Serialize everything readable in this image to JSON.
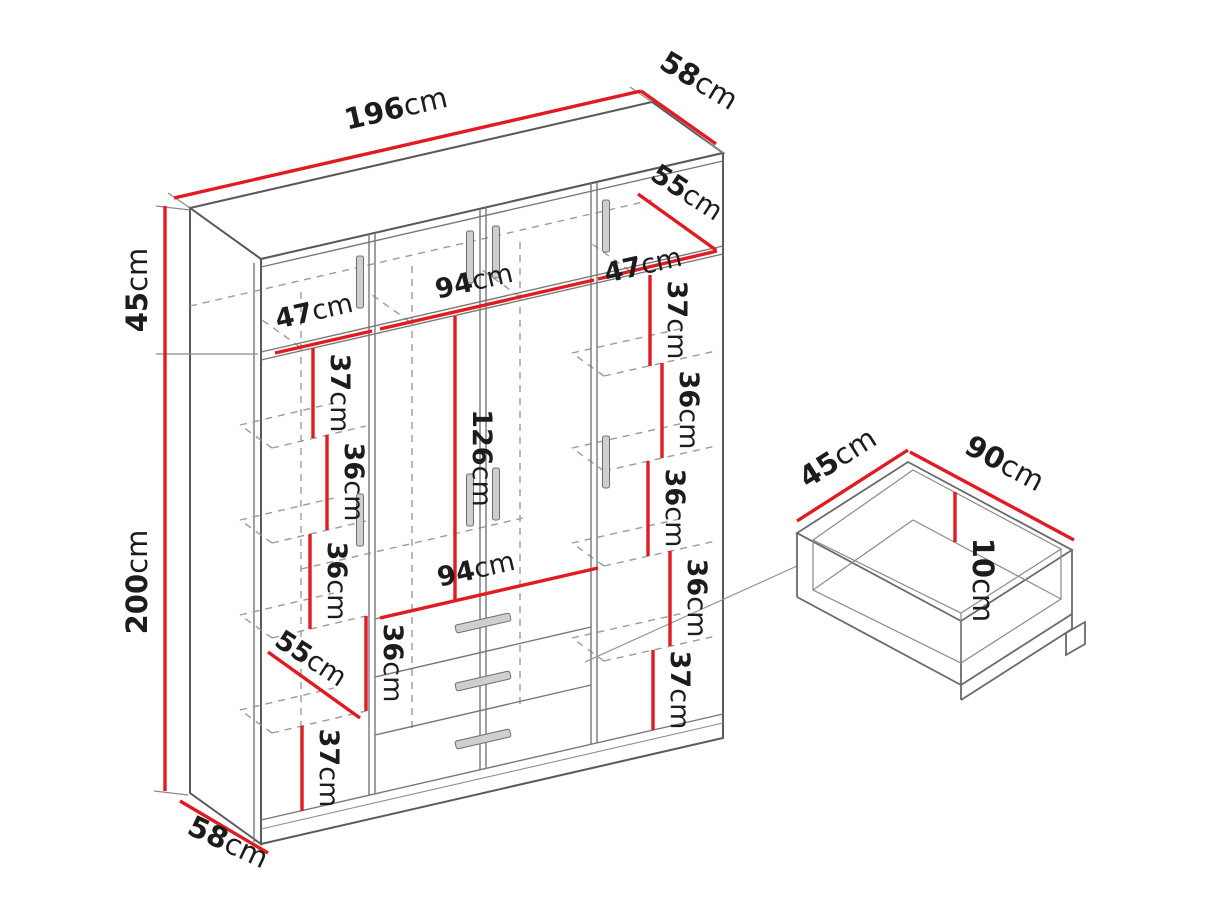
{
  "diagram": {
    "type": "furniture-dimension-diagram",
    "subject": "four-door wardrobe with drawers and drawer detail inset",
    "unit": "cm",
    "colors": {
      "dimension_red": "#e01b22",
      "line_gray": "#5a5a5a",
      "dash_gray": "#9b9b9b",
      "text": "#1c1c1c",
      "handle_gray": "#cfcfcf"
    },
    "wardrobe": {
      "overall_width": {
        "v": "196",
        "u": "cm"
      },
      "top_depth": {
        "v": "58",
        "u": "cm"
      },
      "top_section_height": {
        "v": "45",
        "u": "cm"
      },
      "total_height": {
        "v": "200",
        "u": "cm"
      },
      "bottom_depth": {
        "v": "58",
        "u": "cm"
      },
      "top_row": {
        "left": {
          "v": "47",
          "u": "cm"
        },
        "middle": {
          "v": "94",
          "u": "cm"
        },
        "right": {
          "v": "47",
          "u": "cm"
        },
        "depth": {
          "v": "55",
          "u": "cm"
        }
      },
      "left_column": [
        {
          "v": "37",
          "u": "cm"
        },
        {
          "v": "36",
          "u": "cm"
        },
        {
          "v": "36",
          "u": "cm"
        },
        {
          "v": "55",
          "u": "cm"
        },
        {
          "v": "36",
          "u": "cm"
        },
        {
          "v": "37",
          "u": "cm"
        }
      ],
      "middle_column": {
        "hanging_height": {
          "v": "126",
          "u": "cm"
        },
        "bottom_width": {
          "v": "94",
          "u": "cm"
        }
      },
      "right_column": [
        {
          "v": "37",
          "u": "cm"
        },
        {
          "v": "36",
          "u": "cm"
        },
        {
          "v": "36",
          "u": "cm"
        },
        {
          "v": "36",
          "u": "cm"
        },
        {
          "v": "37",
          "u": "cm"
        }
      ]
    },
    "drawer_detail": {
      "depth": {
        "v": "45",
        "u": "cm"
      },
      "width": {
        "v": "90",
        "u": "cm"
      },
      "height": {
        "v": "10",
        "u": "cm"
      }
    }
  }
}
